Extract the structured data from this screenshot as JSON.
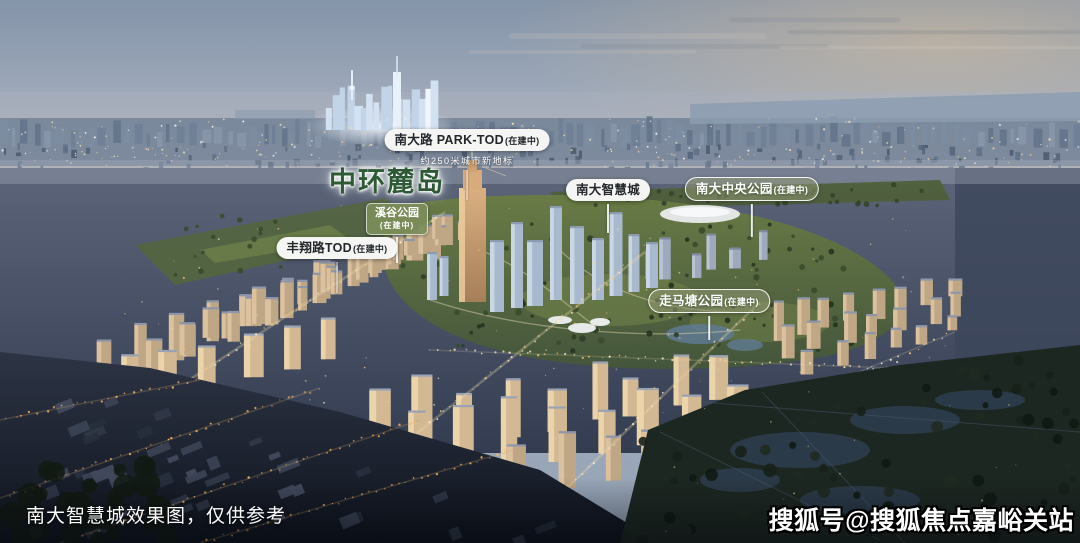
{
  "scene": {
    "caption": "南大智慧城效果图，仅供参考",
    "watermark": "搜狐号@搜狐焦点嘉峪关站"
  },
  "labels": {
    "park_tod": {
      "title": "南大路 PARK-TOD",
      "status": "(在建中)",
      "subtitle": "约250米城市新地标"
    },
    "zhonghuan_island": {
      "title": "中环麓岛"
    },
    "xigu_park": {
      "title": "溪谷公园",
      "status": "(在建中)"
    },
    "fengxiang_tod": {
      "title": "丰翔路TOD",
      "status": "(在建中)"
    },
    "nanda_smart_city": {
      "title": "南大智慧城"
    },
    "nanda_central_park": {
      "title": "南大中央公园",
      "status": "(在建中)"
    },
    "zoumatang_park": {
      "title": "走马塘公园",
      "status": "(在建中)"
    }
  },
  "colors": {
    "island_text_green": "#2d5a35",
    "badge_white_bg": "#f5f6f3",
    "badge_green_bg": "#7c8d5a",
    "badge_text_dark": "#23272b",
    "badge_text_light": "#ffffff",
    "sky_dusk": "#8494a9",
    "park_green": "#5c6e44"
  }
}
